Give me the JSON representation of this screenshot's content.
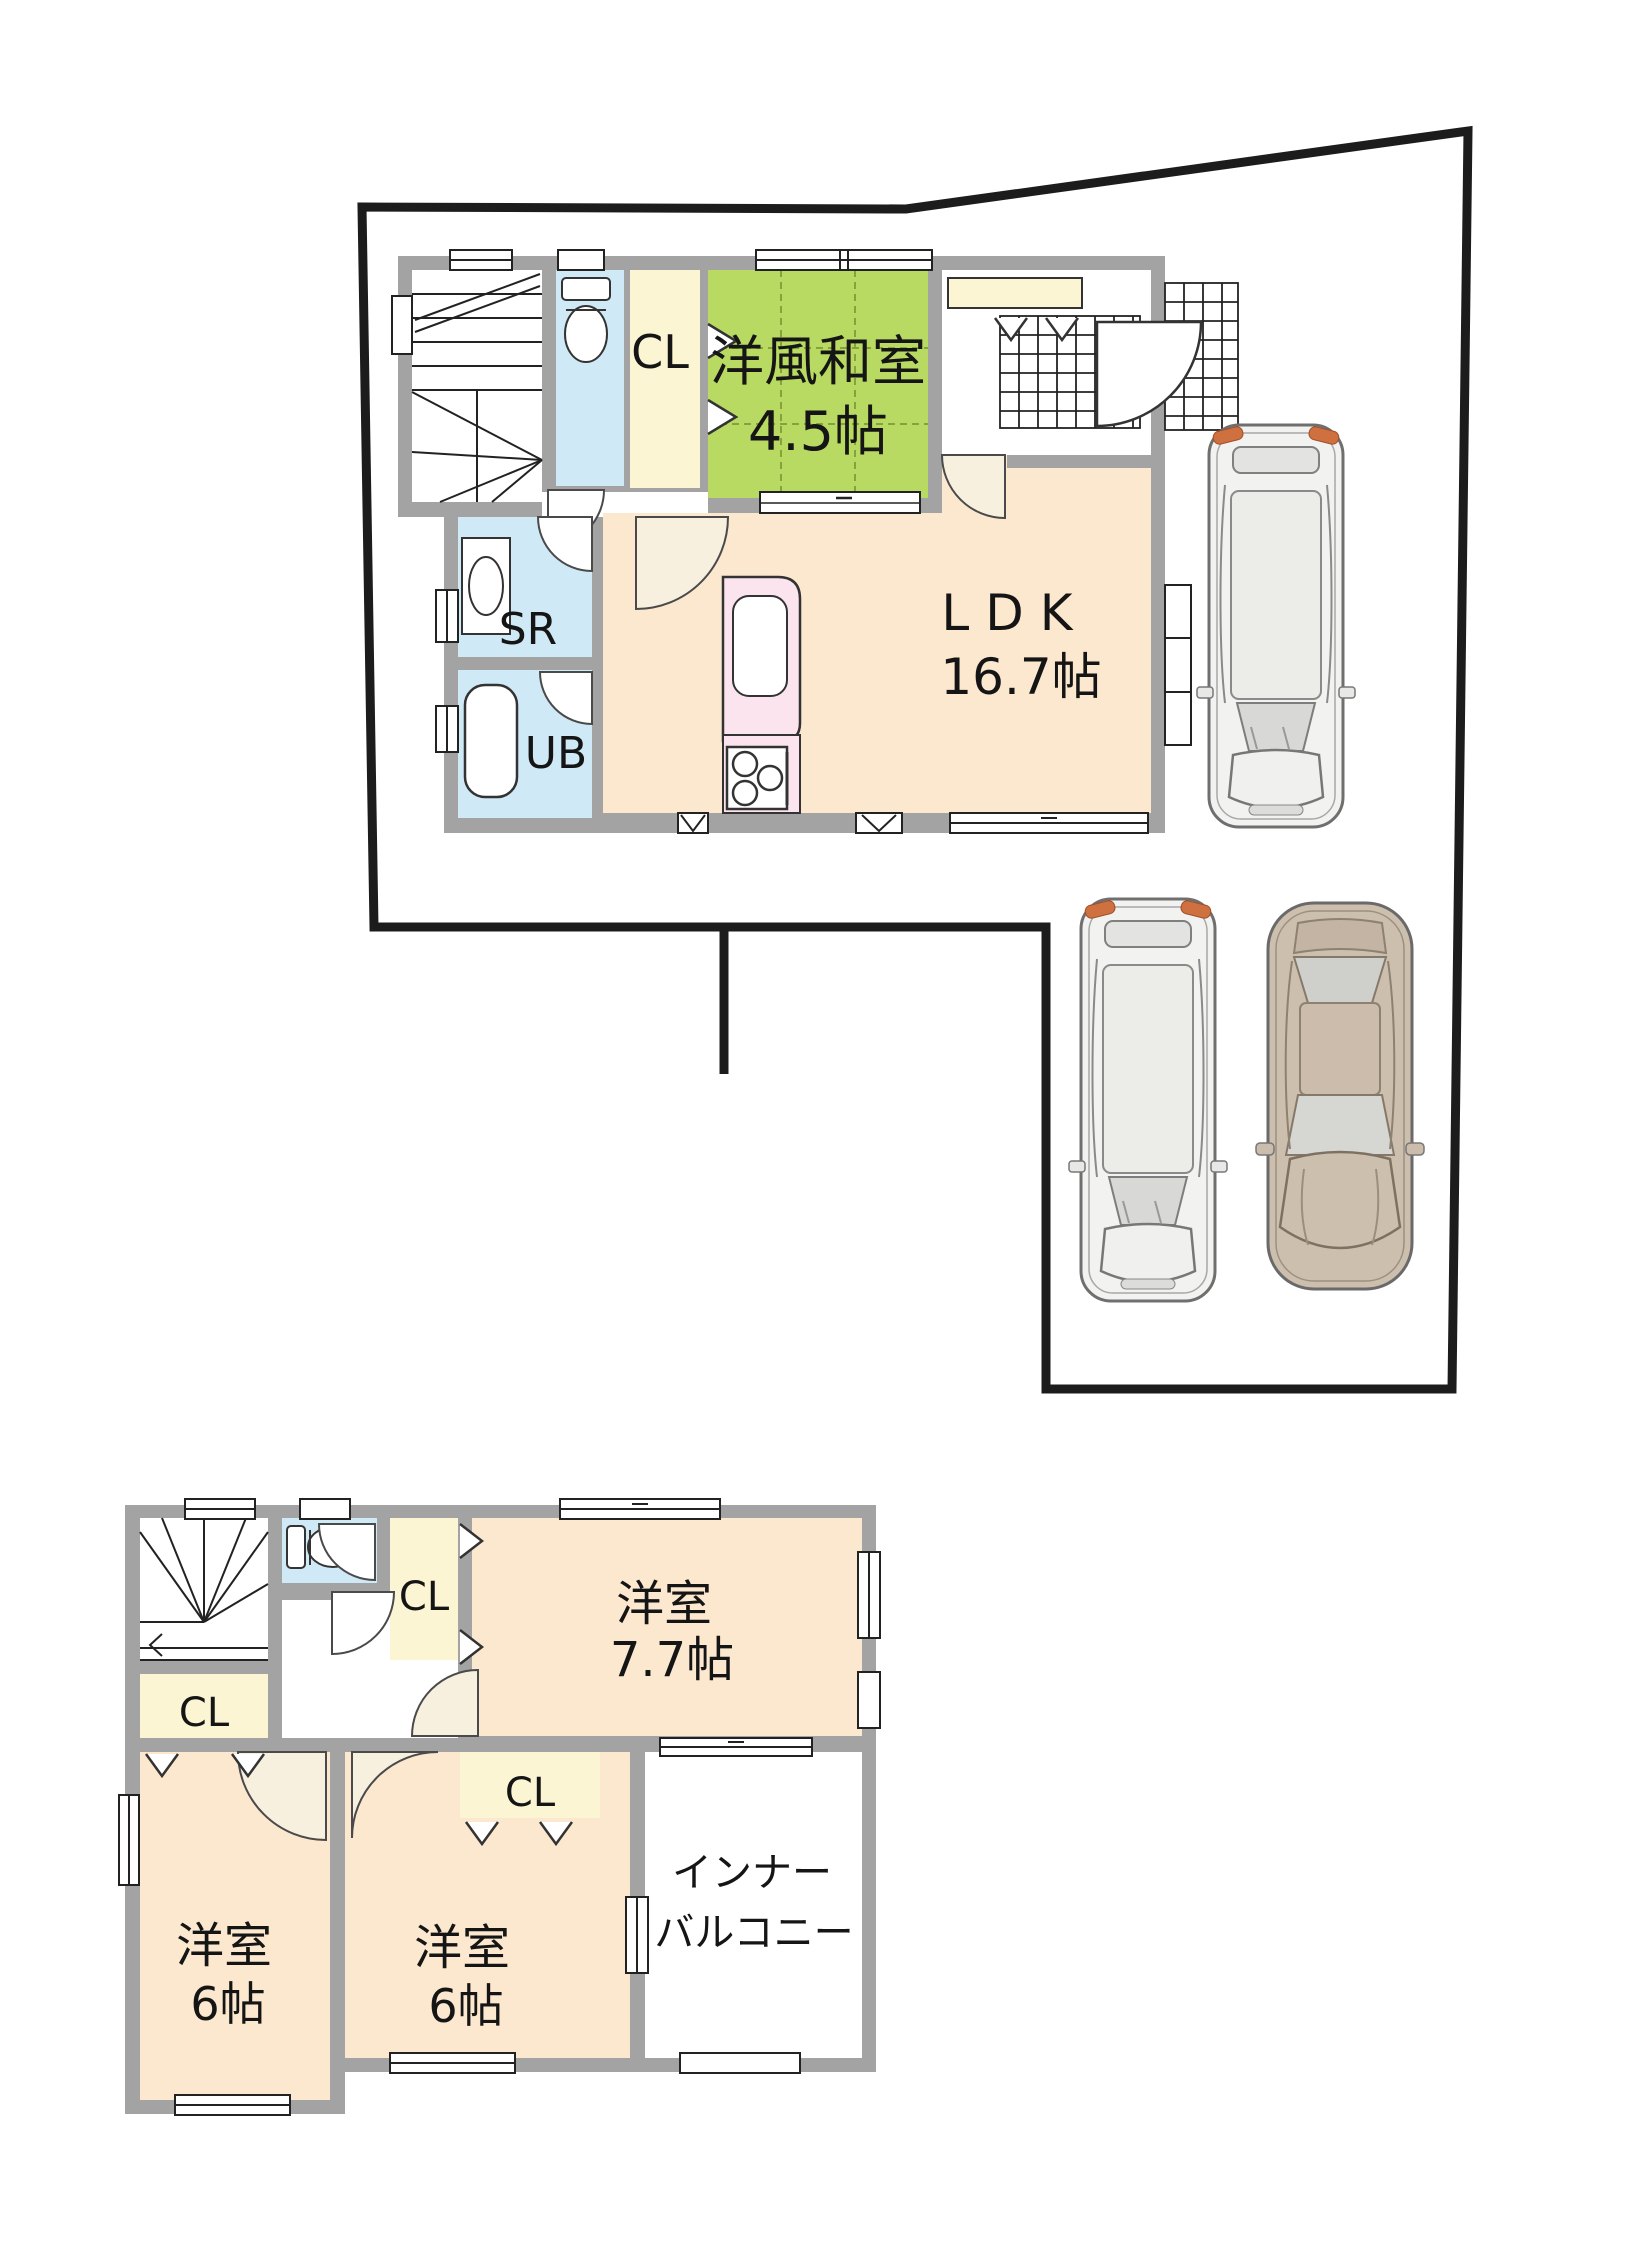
{
  "floor1": {
    "closet_label": "CL",
    "washitsu_name": "洋風和室",
    "washitsu_size": "4.5帖",
    "storage_label": "SR",
    "bath_label": "UB",
    "ldk_name": "LDK",
    "ldk_size": "16.7帖"
  },
  "floor2": {
    "closet_a_label": "CL",
    "closet_b_label": "CL",
    "closet_c_label": "CL",
    "bedroom1_name": "洋室",
    "bedroom1_size": "7.7帖",
    "bedroom2_name": "洋室",
    "bedroom2_size": "6帖",
    "bedroom3_name": "洋室",
    "bedroom3_size": "6帖",
    "balcony_line1": "インナー",
    "balcony_line2": "バルコニー"
  },
  "colors": {
    "wall": "#a3a3a3",
    "floor_peach": "#fbe8cf",
    "tatami": "#b9da62",
    "tatami_grid": "#86a23b",
    "wet_room": "#cfe9f6",
    "closet": "#fbf5d3",
    "kitchen": "#fce4ee",
    "door_arc": "#f7f0de",
    "boundary": "#1c1c1c",
    "car_white": "#f2f2f0",
    "car_beige": "#cdbfae",
    "tail_lamp": "#cf7040"
  }
}
